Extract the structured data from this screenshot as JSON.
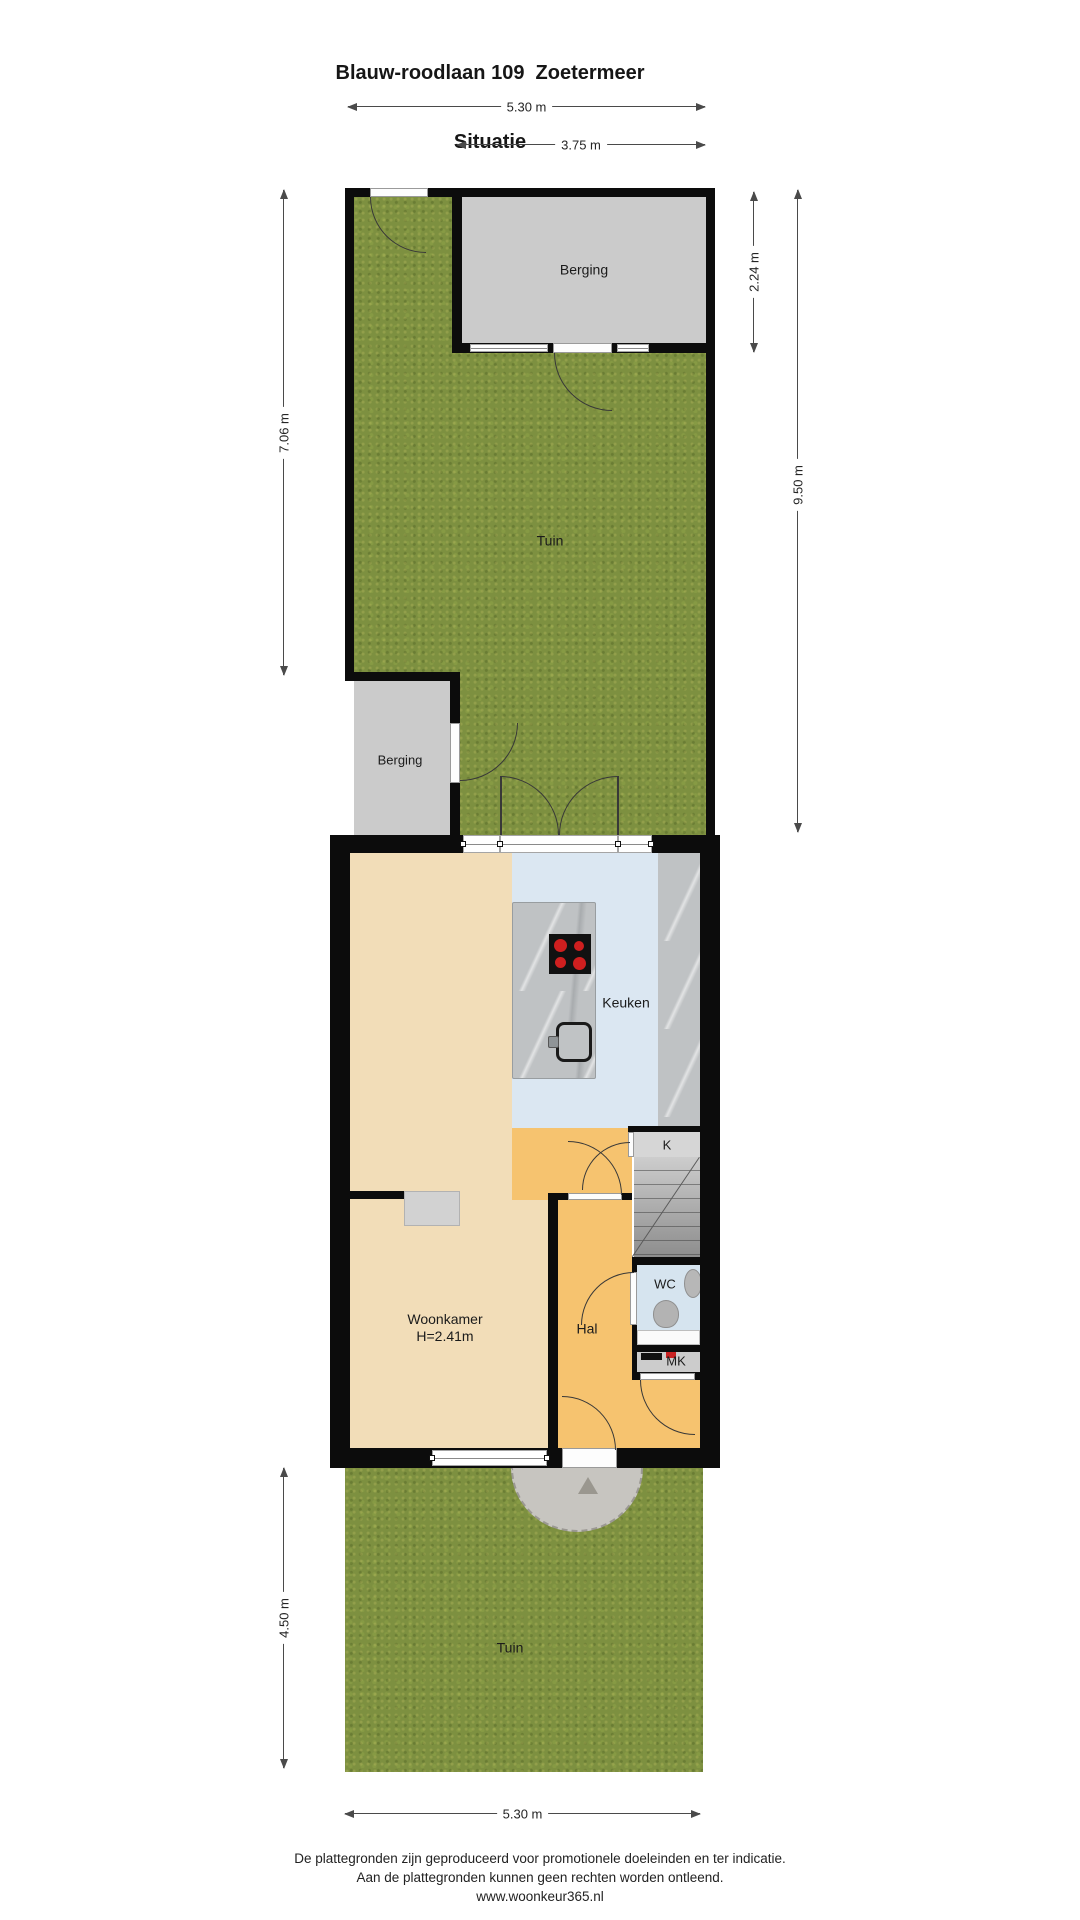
{
  "title": {
    "line1": "Blauw-roodlaan 109  Zoetermeer",
    "line2": "Situatie"
  },
  "dimensions": {
    "top_width": "5.30 m",
    "berging_width": "3.75 m",
    "left_garden_height": "7.06 m",
    "berging_height": "2.24 m",
    "right_garden_height": "9.50 m",
    "front_garden_height": "4.50 m",
    "bottom_width": "5.30 m"
  },
  "rooms": {
    "berging_top": "Berging",
    "garden_back": "Tuin",
    "berging_side": "Berging",
    "kitchen": "Keuken",
    "closet": "K",
    "wc": "WC",
    "meter_cupboard": "MK",
    "hall": "Hal",
    "living_room": "Woonkamer",
    "living_room_height": "H=2.41m",
    "garden_front": "Tuin"
  },
  "footer": {
    "line1": "De plattegronden zijn geproduceerd voor promotionele doeleinden en ter indicatie.",
    "line2": "Aan de plattegronden kunnen geen rechten worden ontleend.",
    "line3": "www.woonkeur365.nl"
  },
  "icons": [
    "stove-icon",
    "sink-icon",
    "toilet-icon",
    "basin-icon",
    "meter-box-icon",
    "porch-triangle-icon"
  ],
  "colors": {
    "wall": "#0c0c0c",
    "grass": "#7d9040",
    "storage": "#cbcbcb",
    "living_floor": "#f2ddb8",
    "hall_floor": "#f6c36f",
    "kitchen_floor": "#dbe7f2",
    "wc_floor": "#d6e4ef",
    "counter": "#bfc2c4",
    "porch": "#c7c5c0",
    "dim": "#4a4a4a"
  }
}
